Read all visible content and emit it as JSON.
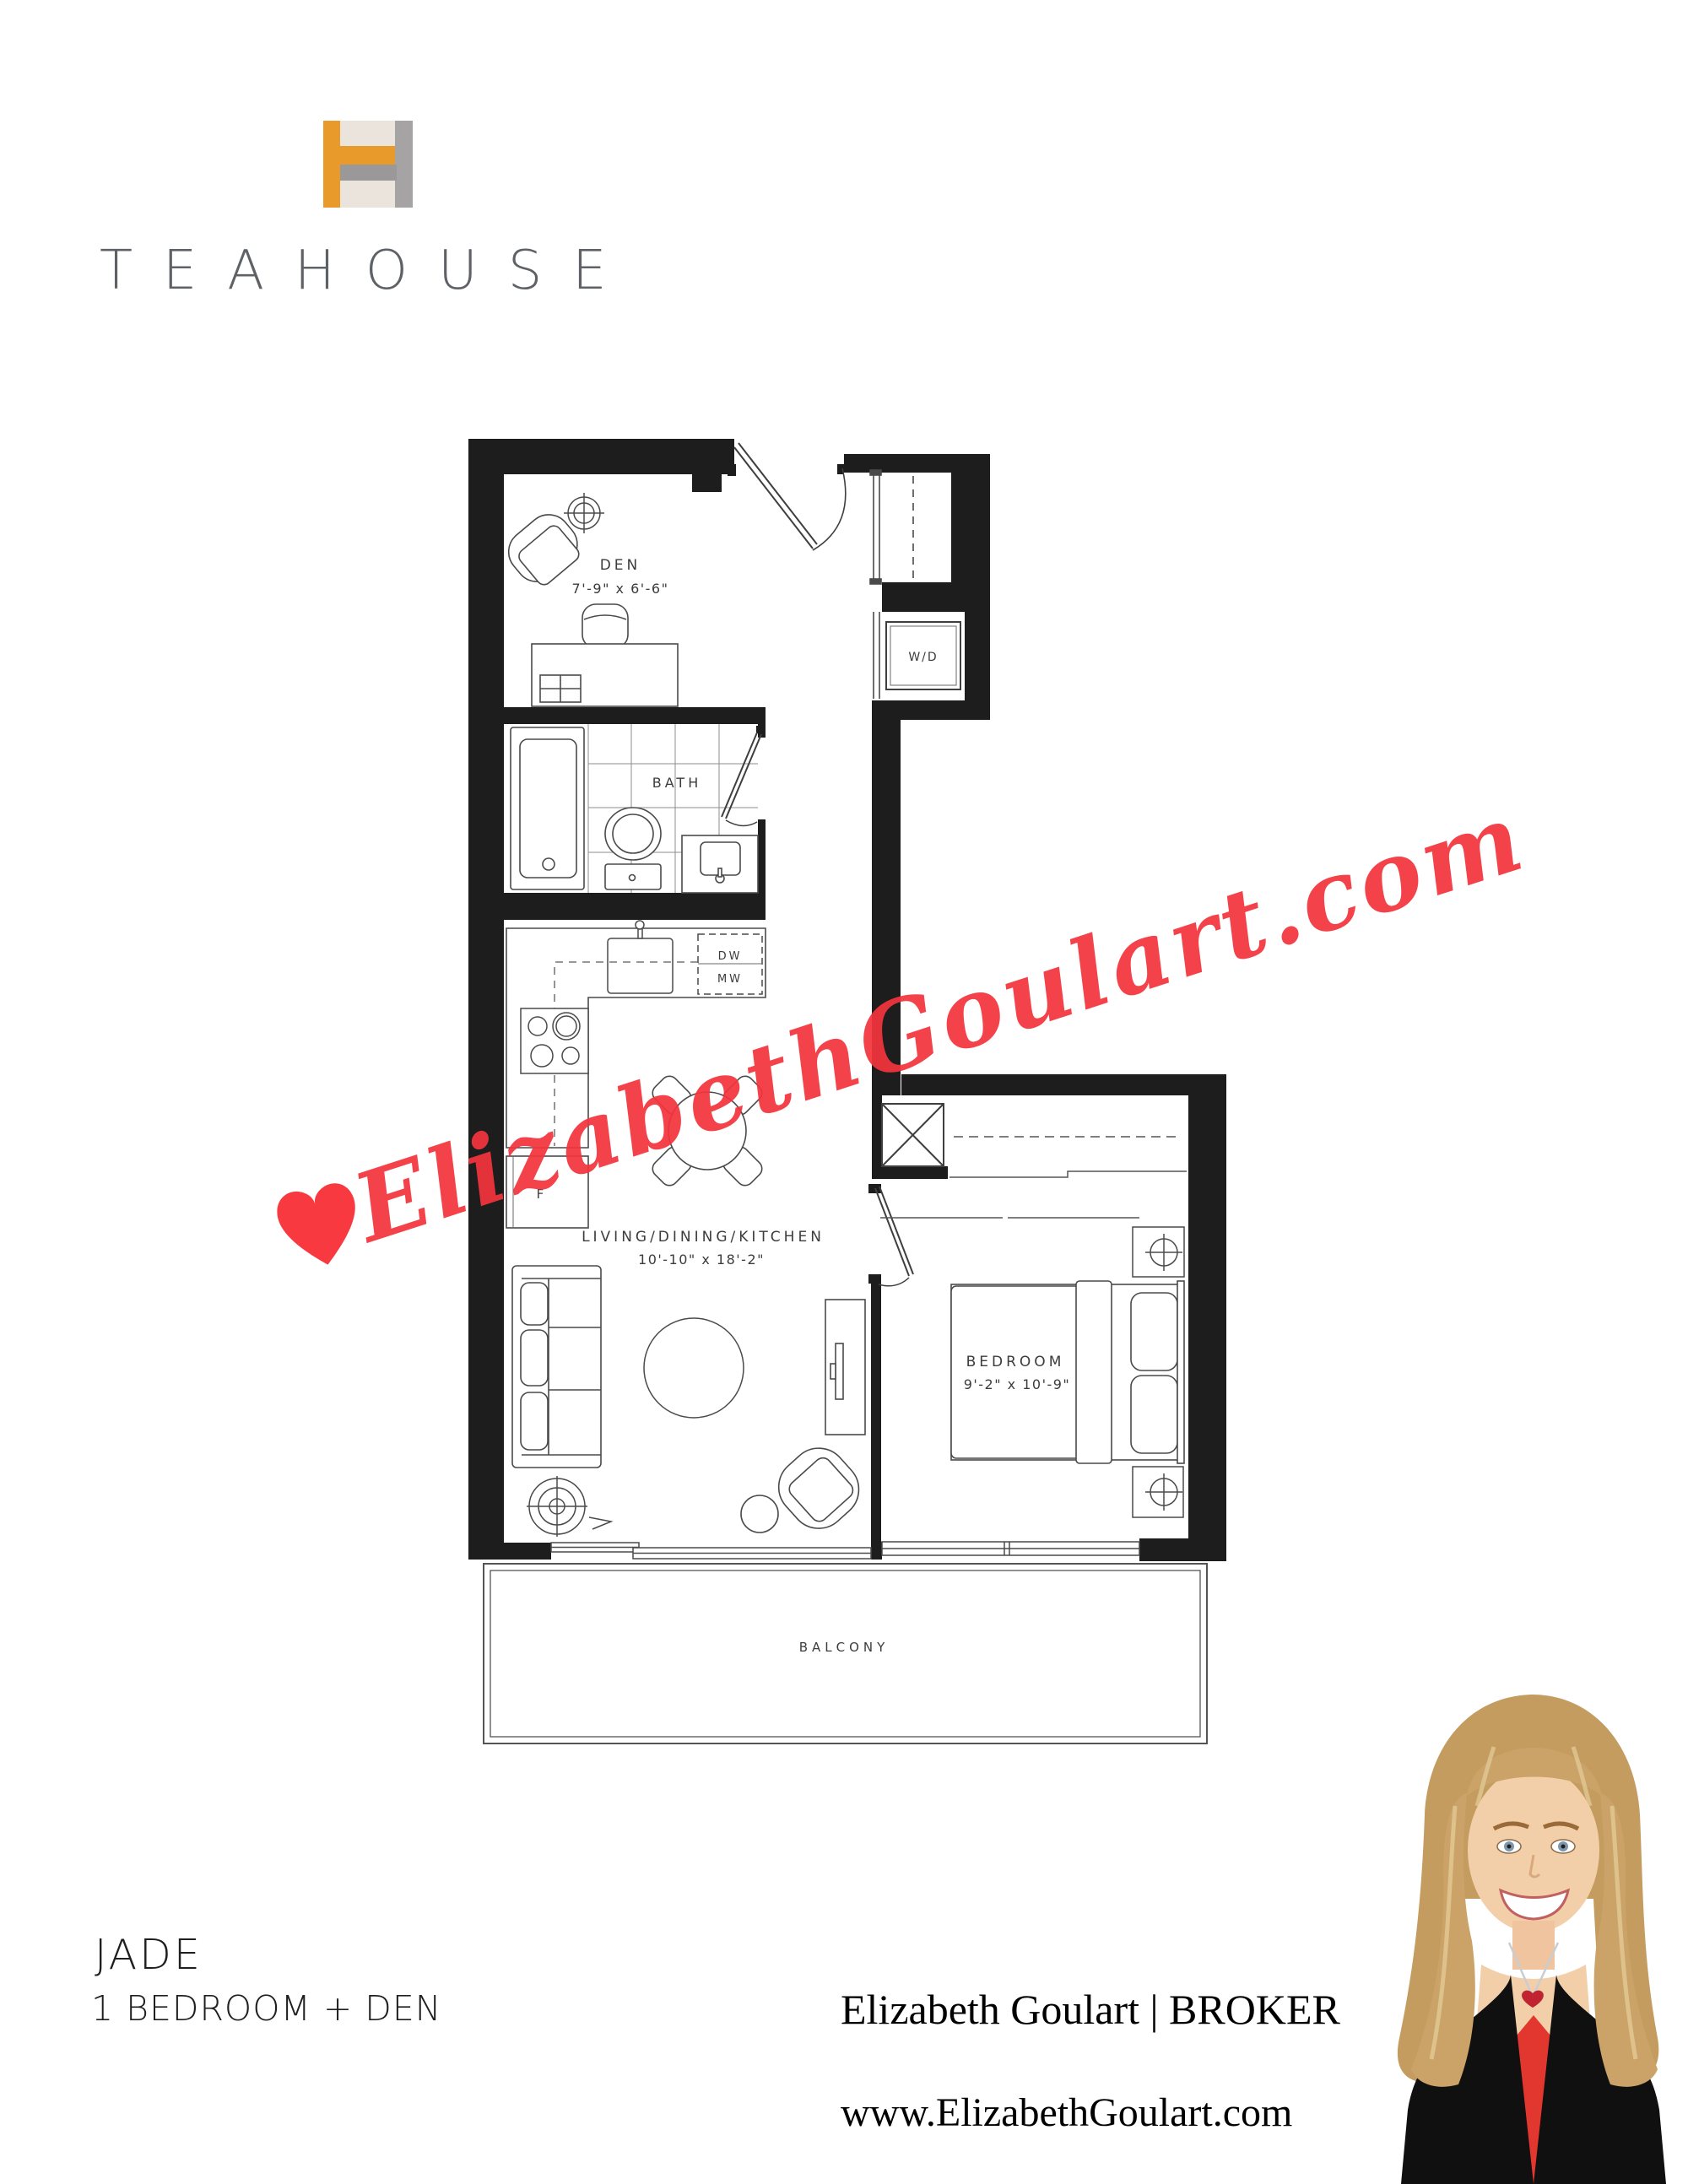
{
  "logo": {
    "wordmark": "TEAHOUSE",
    "icon_colors": {
      "orange": "#E89B2B",
      "gray": "#A5A3A4",
      "cream": "#EAE4DC"
    }
  },
  "plan": {
    "den": {
      "label": "DEN",
      "dims": "7'-9\" x 6'-6\""
    },
    "bath": {
      "label": "BATH"
    },
    "laundry": {
      "label": "W/D"
    },
    "kitchen": {
      "dishwasher": "DW",
      "microwave": "MW",
      "fridge": "F"
    },
    "living": {
      "label": "LIVING/DINING/KITCHEN",
      "dims": "10'-10\" x 18'-2\""
    },
    "bedroom": {
      "label": "BEDROOM",
      "dims": "9'-2\" x 10'-9\""
    },
    "balcony": {
      "label": "BALCONY"
    }
  },
  "watermark": {
    "text": "ElizabethGoulart.com",
    "color": "#F4343D"
  },
  "footer": {
    "unit_name": "JADE",
    "unit_type": "1 BEDROOM + DEN",
    "broker_line": "Elizabeth Goulart | BROKER",
    "website": "www.ElizabethGoulart.com"
  }
}
